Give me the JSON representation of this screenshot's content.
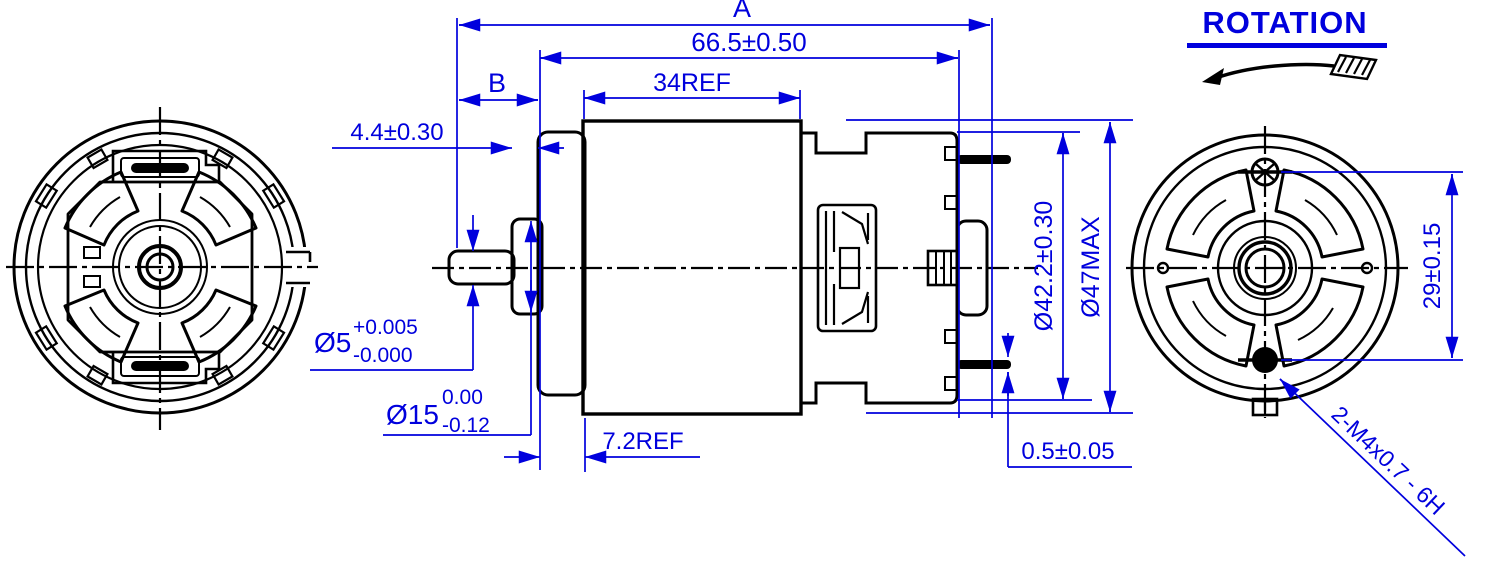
{
  "drawing": {
    "rotation_label": "ROTATION",
    "dims": {
      "overall_len": "A",
      "body_len": "66.5±0.50",
      "can_len": "34REF",
      "shaft_ext": "B",
      "boss_height": "4.4±0.30",
      "shaft_dia": "Ø5",
      "shaft_tol_upper": "+0.005",
      "shaft_tol_lower": "-0.000",
      "boss_dia": "Ø15",
      "boss_tol_upper": "0.00",
      "boss_tol_lower": "-0.12",
      "flange_thk": "7.2REF",
      "terminal_thk": "0.5±0.05",
      "cap_dia": "Ø42.2±0.30",
      "body_dia": "Ø47MAX",
      "hole_spacing": "29±0.15",
      "mounting_thread": "2-M4x0.7 - 6H"
    },
    "colors": {
      "dimension": "#0000dd",
      "line": "#000000",
      "background": "#ffffff"
    }
  }
}
